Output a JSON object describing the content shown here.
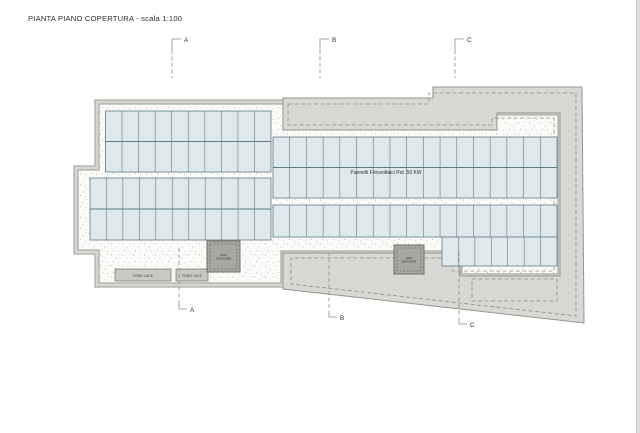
{
  "title": "PIANTA PIANO COPERTURA - scala 1:100",
  "annotations": {
    "panels_label": "Pannelli Fotovoltaici Pot. 50 KW"
  },
  "skylights": [
    {
      "label": "FORO LUCE"
    },
    {
      "label": "FORO LUCE"
    }
  ],
  "shafts": [
    {
      "line1": "VANO",
      "line2": "ASCENSORE"
    },
    {
      "line1": "VANO",
      "line2": "ASCENSORE"
    }
  ],
  "sections": {
    "top": [
      {
        "label": "A"
      },
      {
        "label": "B"
      },
      {
        "label": "C"
      }
    ],
    "bottom": [
      {
        "label": "A"
      },
      {
        "label": "B"
      },
      {
        "label": "C"
      }
    ]
  },
  "panel_arrays": [
    {
      "x": 105.5,
      "y": 111,
      "w": 165.5,
      "h": 61,
      "cols": 10,
      "rows": 2
    },
    {
      "x": 90,
      "y": 178,
      "w": 181,
      "h": 62,
      "cols": 11,
      "rows": 2
    },
    {
      "x": 273,
      "y": 137,
      "w": 284,
      "h": 61,
      "cols": 17,
      "rows": 2
    },
    {
      "x": 273,
      "y": 205,
      "w": 284,
      "h": 32,
      "cols": 17,
      "rows": 1
    },
    {
      "x": 442,
      "y": 237,
      "w": 115,
      "h": 29,
      "cols": 7,
      "rows": 1
    }
  ],
  "colors": {
    "panel_fill": "#dfe9ec",
    "panel_grid": "#5f7d89",
    "terrace": "#d8d8d4",
    "wall_dark": "#96968e",
    "wall_light": "#d6d6d2",
    "stipple": "#a0a098",
    "dashed": "#8f8f8a",
    "text": "#2e2e2c"
  }
}
